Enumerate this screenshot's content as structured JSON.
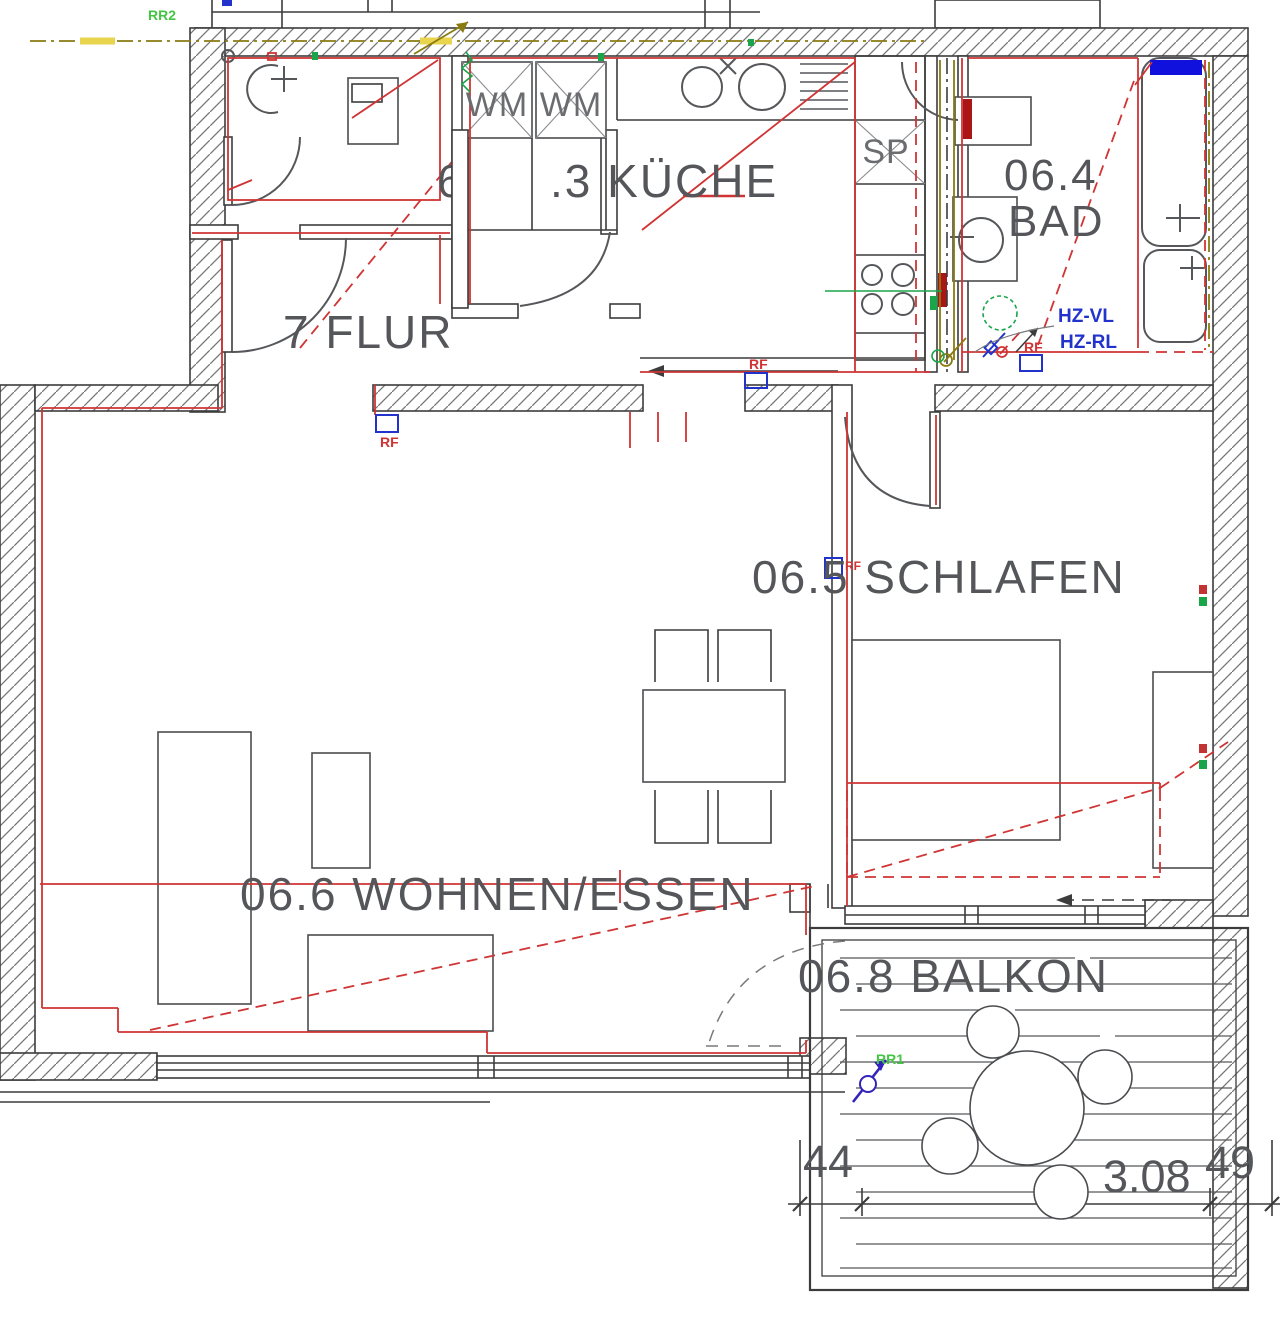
{
  "drawing": {
    "rooms": {
      "kueche_fragment": "6",
      "kueche": ".3 KÜCHE",
      "bad_number": "06.4",
      "bad_name": "BAD",
      "flur": "7 FLUR",
      "schlafen": "06.5 SCHLAFEN",
      "wohnen_essen": "06.6 WOHNEN/ESSEN",
      "balkon": "06.8 BALKON"
    },
    "appliances": {
      "wm_left": "WM",
      "wm_right": "WM",
      "sp": "SP"
    },
    "heating": {
      "hz_vl": "HZ-VL",
      "hz_rl": "HZ-RL"
    },
    "markers": {
      "rf": "RF",
      "rr1": "RR1",
      "rr2": "RR2"
    },
    "dimensions": {
      "seg_left": "44",
      "seg_main": "3.08",
      "seg_right": "49"
    },
    "colors": {
      "wall_line": "#3c3c3c",
      "hatch": "#777777",
      "text_gray": "#54565a",
      "annotation_red": "#d03434",
      "annotation_blue": "#2233cc",
      "annotation_green": "#44c544",
      "pipe_olive": "#8a7a10",
      "highlight_yellow": "#e8d44d",
      "fixture_blue": "#1111dd"
    }
  }
}
